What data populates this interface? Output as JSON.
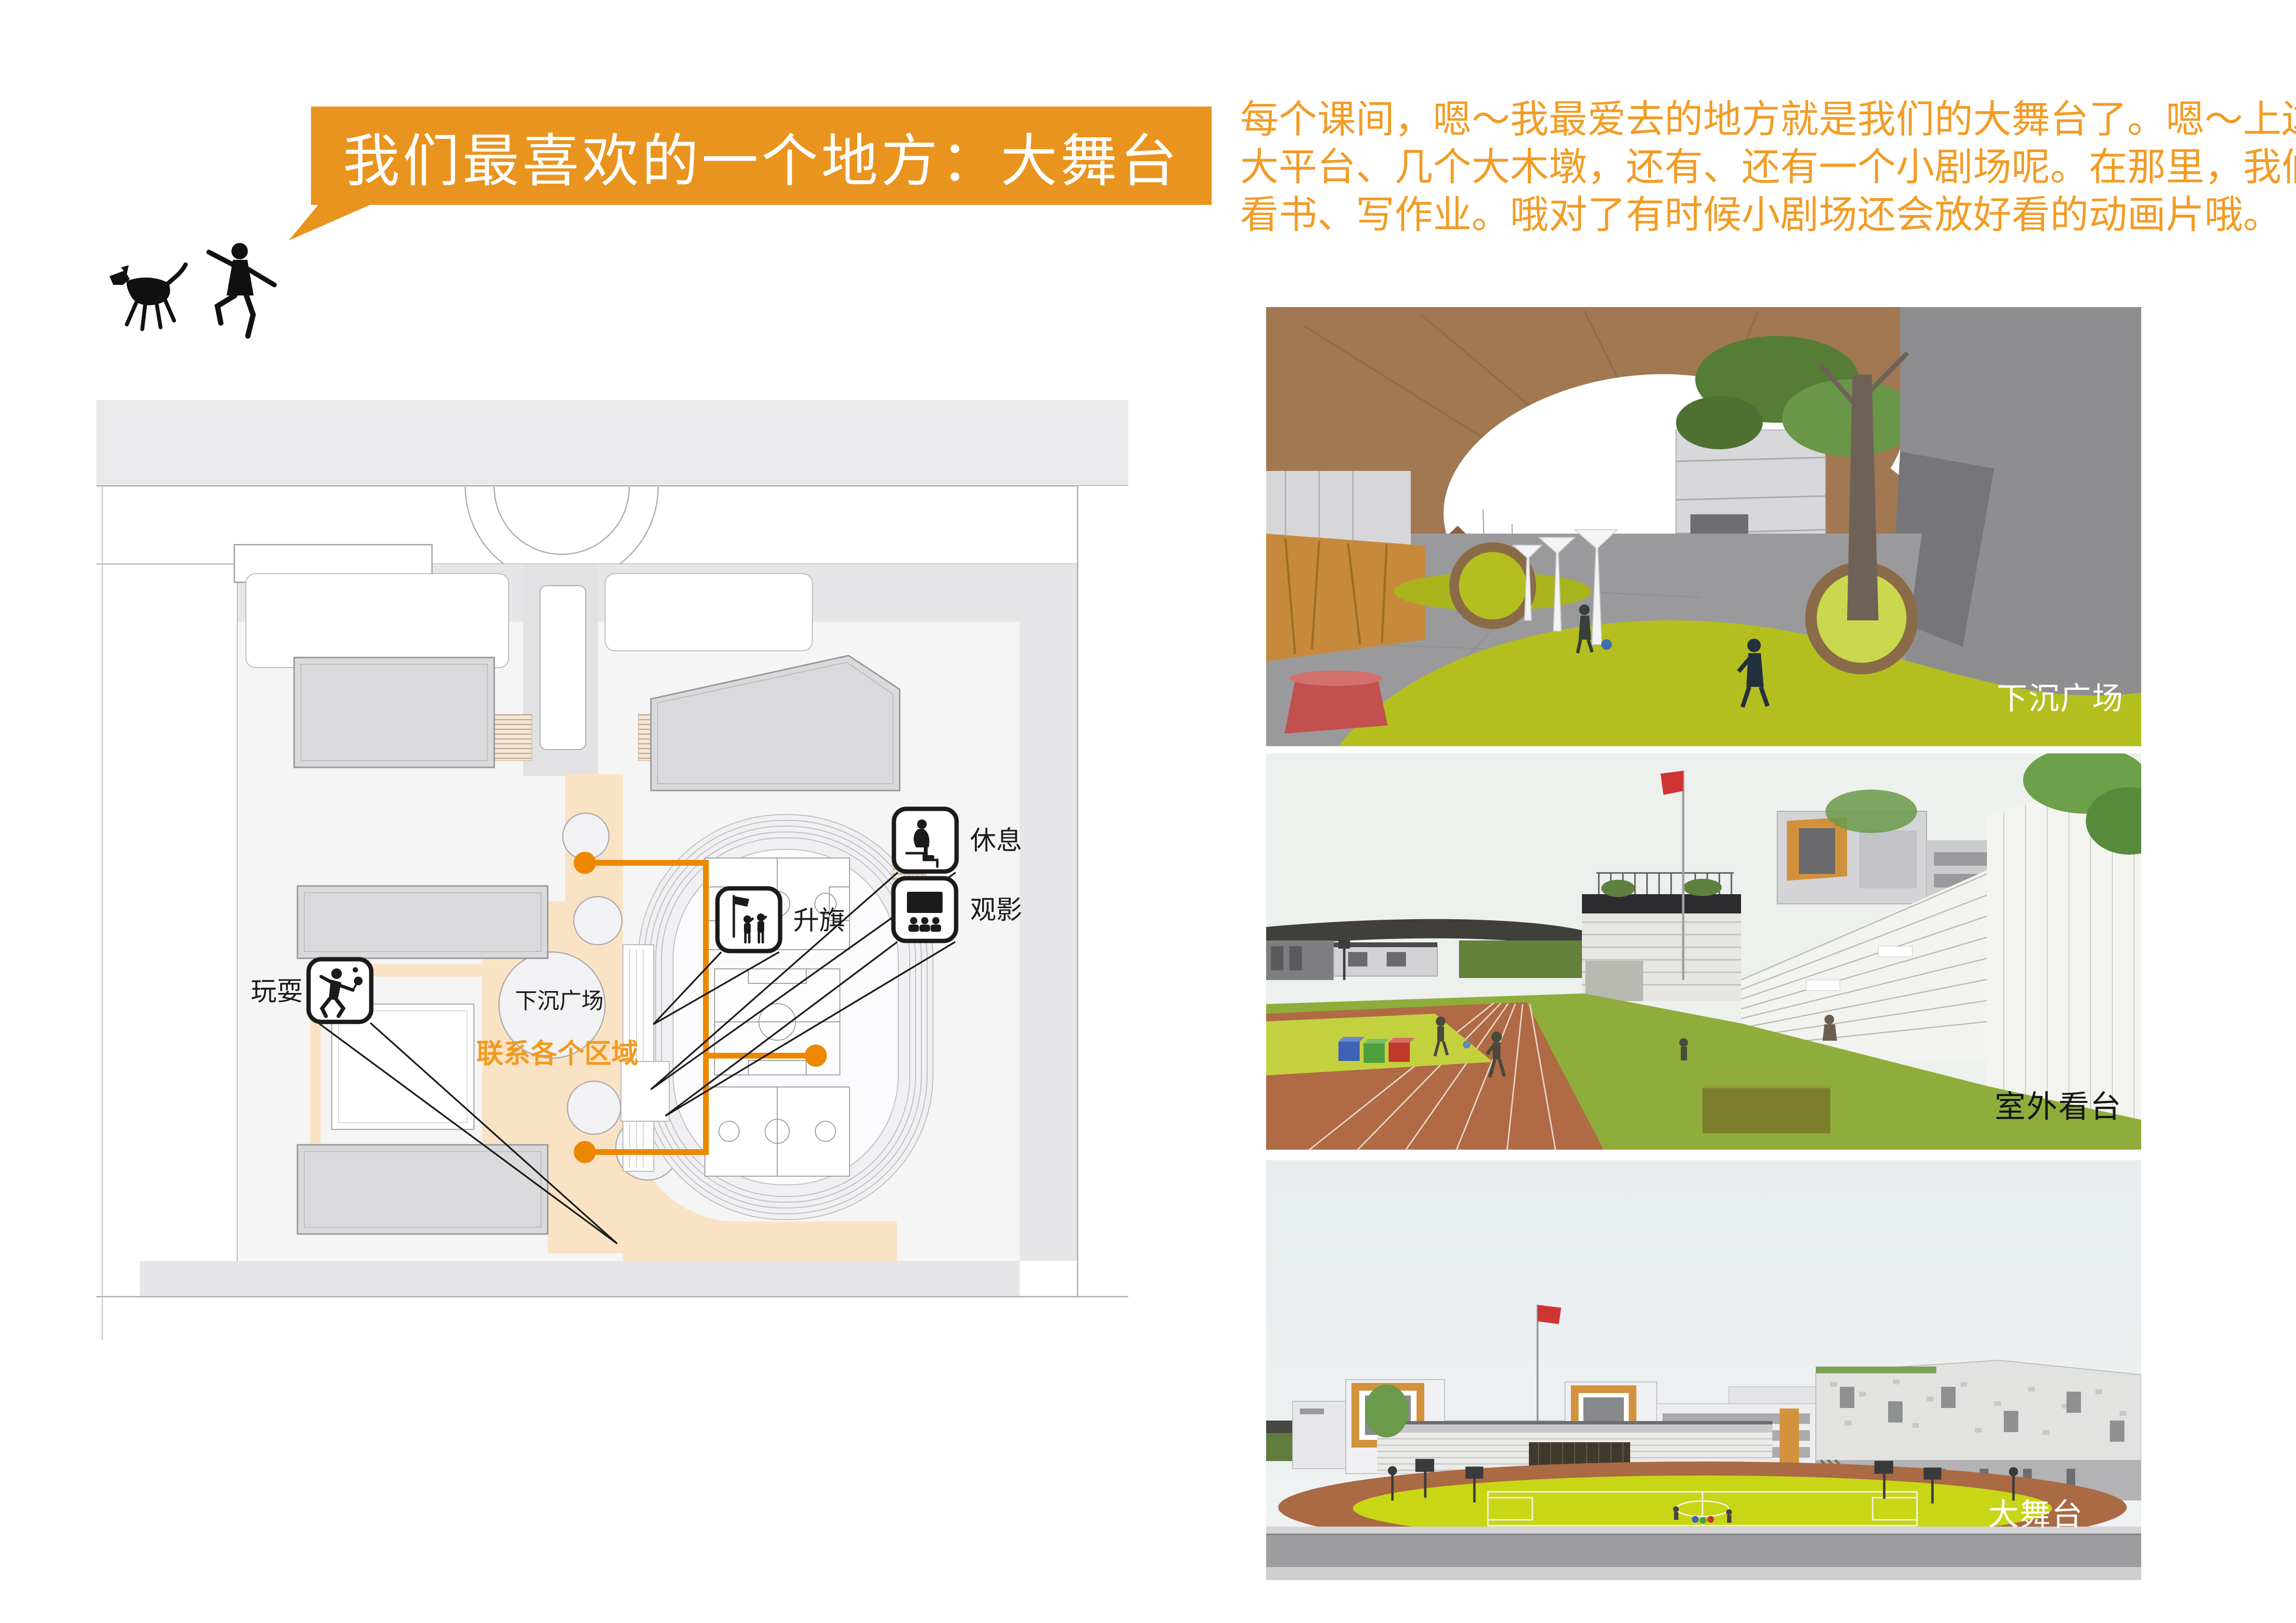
{
  "banner": {
    "title": "我们最喜欢的一个地方：大舞台",
    "bg_color": "#E9941E",
    "text_color": "#FFFFFF"
  },
  "intro": {
    "color": "#F29C25",
    "lines": [
      "每个课间，嗯～我最爱去的地方就是我们的大舞台了。嗯～上边有",
      "大平台、几个大木墩，还有、还有一个小剧场呢。在那里，我们可以玩、",
      "看书、写作业。哦对了有时候小剧场还会放好看的动画片哦。"
    ]
  },
  "site_plan": {
    "labels": {
      "play": "玩耍",
      "rest": "休息",
      "flag_raising": "升旗",
      "movie": "观影",
      "sunken_plaza": "下沉广场",
      "connect_zones": "联系各个区域"
    },
    "colors": {
      "plaza_peach": "#FAE3C5",
      "connector_orange": "#EE8700",
      "building_gray": "#DADADC"
    }
  },
  "renders": [
    {
      "label": "下沉广场"
    },
    {
      "label": "室外看台"
    },
    {
      "label": "大舞台"
    }
  ]
}
